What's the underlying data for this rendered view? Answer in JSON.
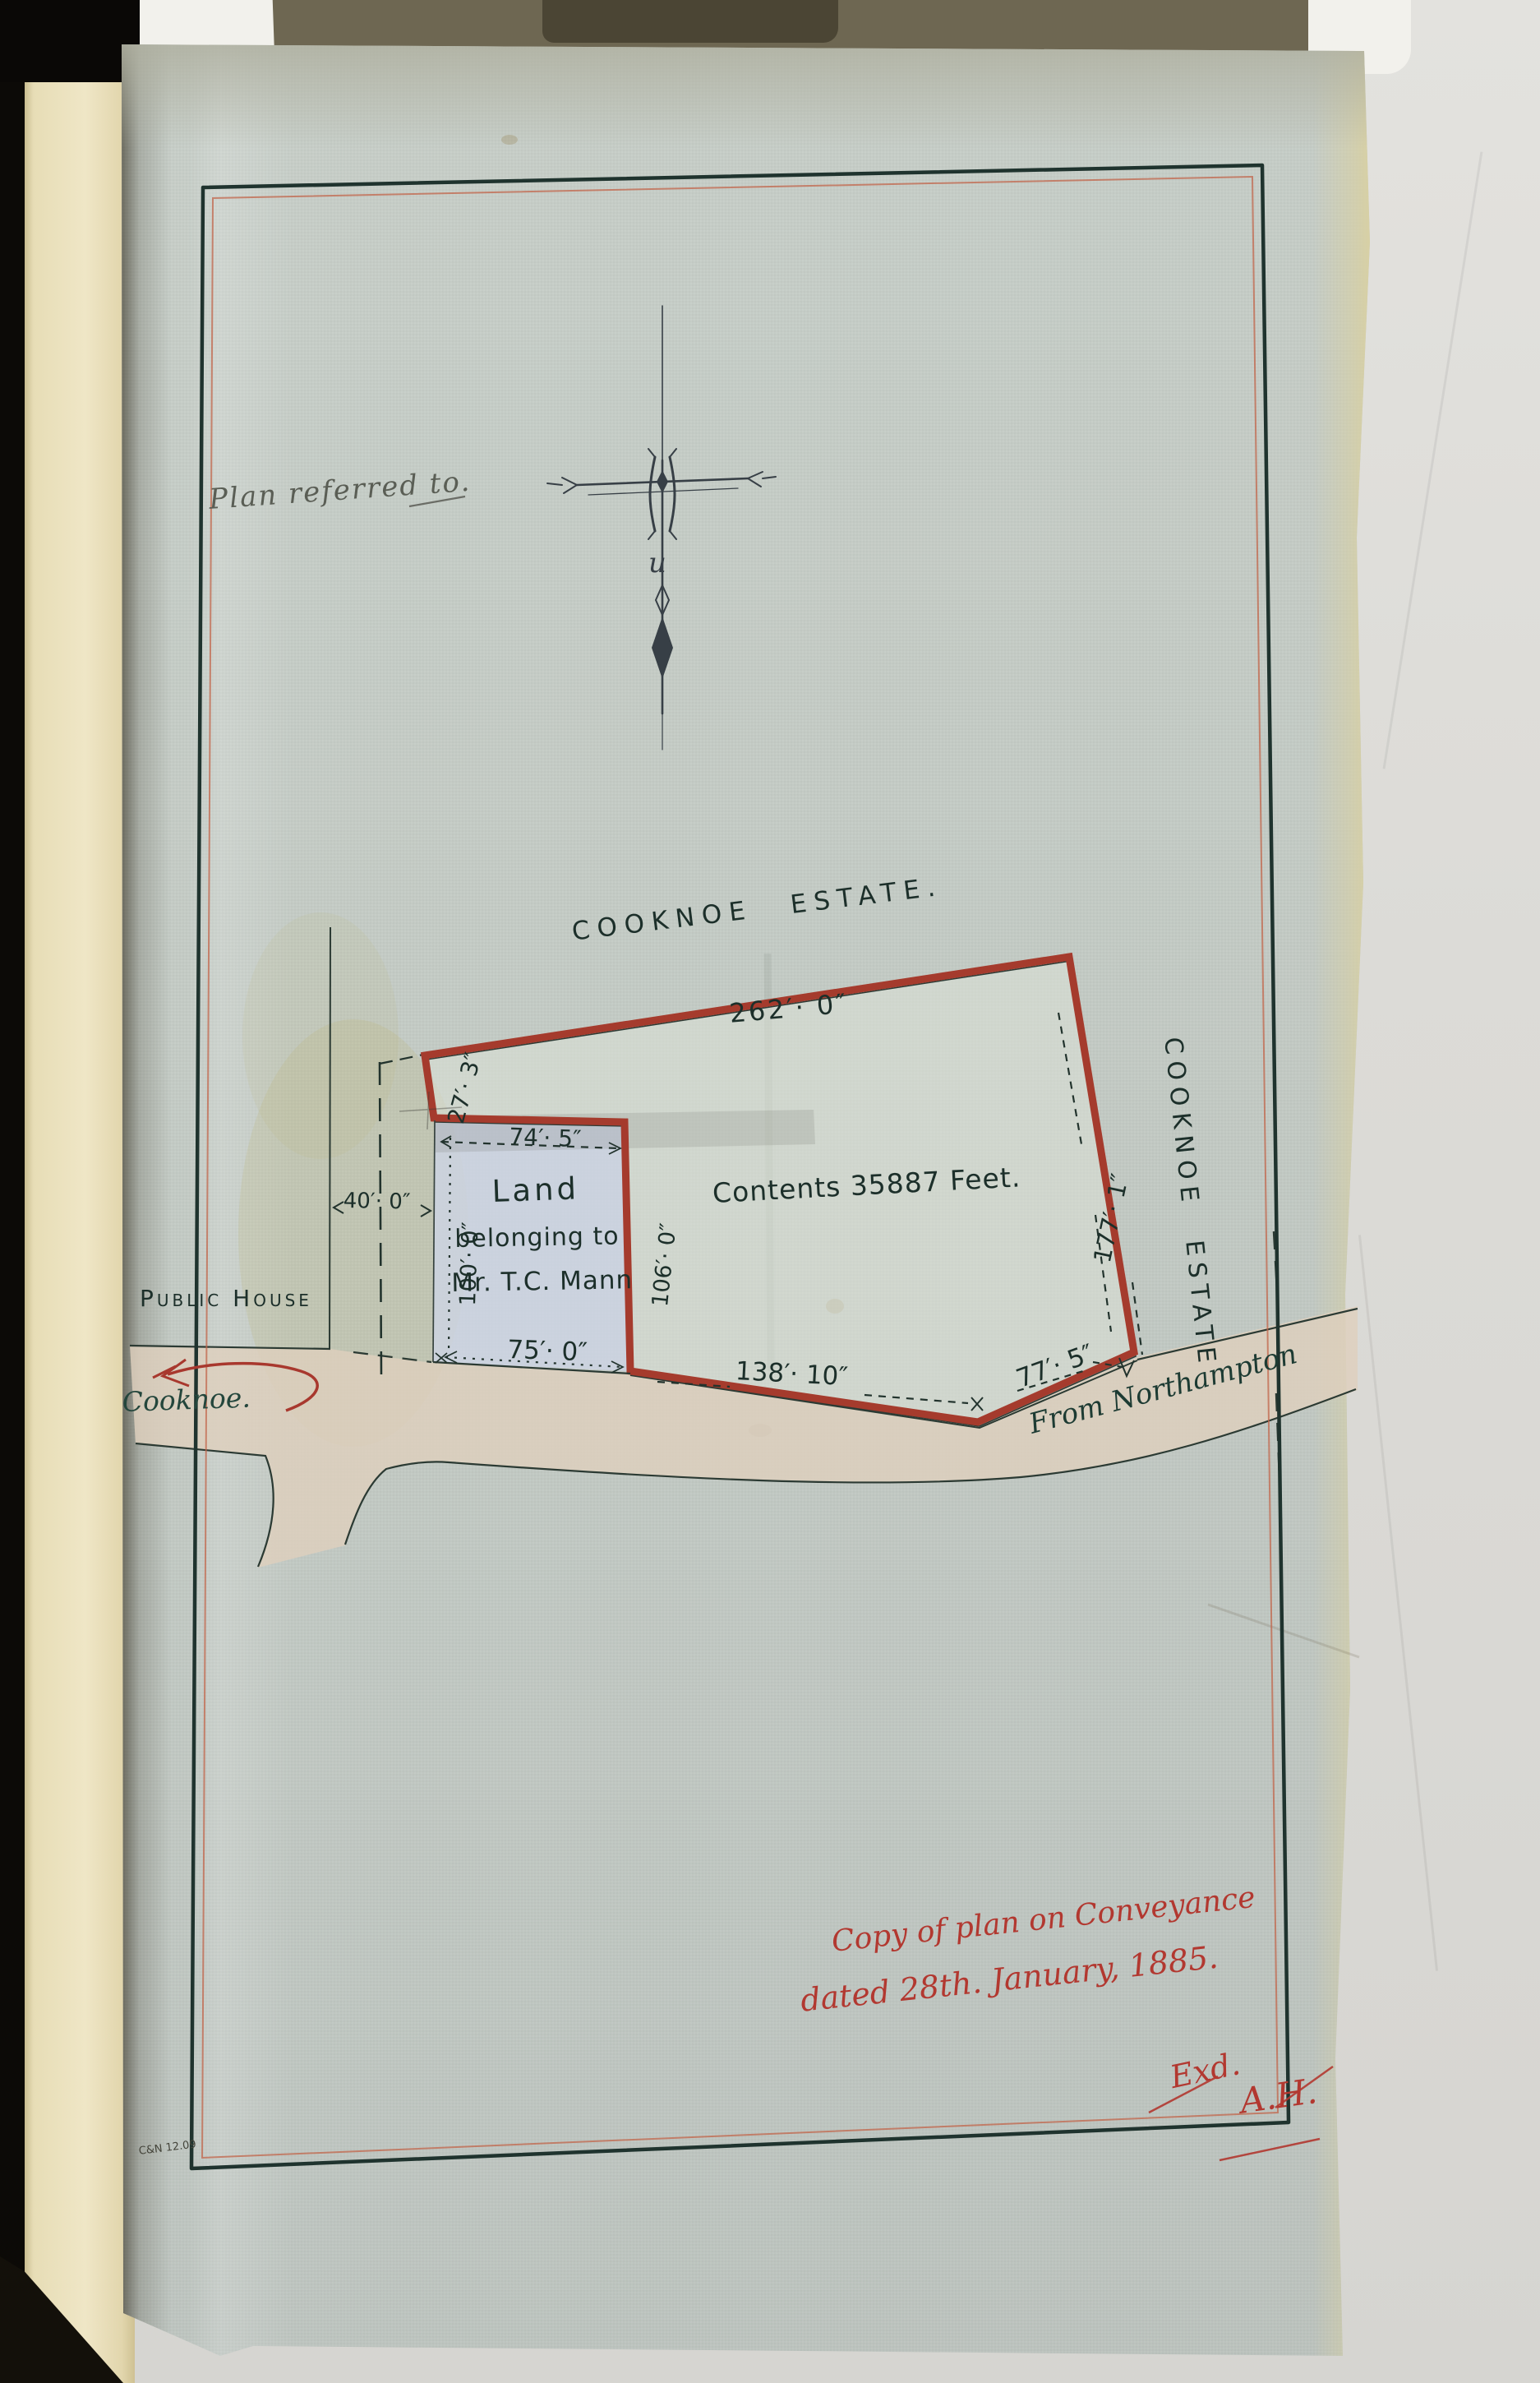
{
  "document": {
    "pencil_note": "Plan referred to.",
    "printer_mark": "C&N 12.09"
  },
  "plan": {
    "estate_label_top": "Cooknoe Estate.",
    "estate_label_east": "Cooknoe Estate",
    "contents_label": "Contents 35887 Feet.",
    "parcel": {
      "line1": "Land",
      "line2": "belonging to",
      "line3": "Mr. T.C. Mann"
    },
    "public_house_label": "Public House",
    "road_label_west": "Cooknoe.",
    "road_label_east": "From Northampton",
    "dimensions": {
      "north_boundary": "262′· 0″",
      "notch_west": "27′· 3″",
      "parcel_north": "74′· 5″",
      "parcel_west": "100′· 0″",
      "parcel_east": "106′· 0″",
      "east_boundary": "177′· 1″",
      "parcel_south": "75′· 0″",
      "south_boundary": "138′· 10″",
      "south_east_boundary": "77′· 5″",
      "west_gap": "40′· 0″"
    }
  },
  "endorsement": {
    "line1": "Copy of plan on Conveyance",
    "line2": "dated 28th. January, 1885.",
    "examined": "Exd.",
    "initials": "A.H."
  },
  "colors": {
    "boundary_red": "#a53b2d",
    "parcel_wash_blue": "#cdd5e5",
    "road_wash_tan": "#ded0bd",
    "ink": "#1c2f2a",
    "note_red": "#b23830"
  }
}
